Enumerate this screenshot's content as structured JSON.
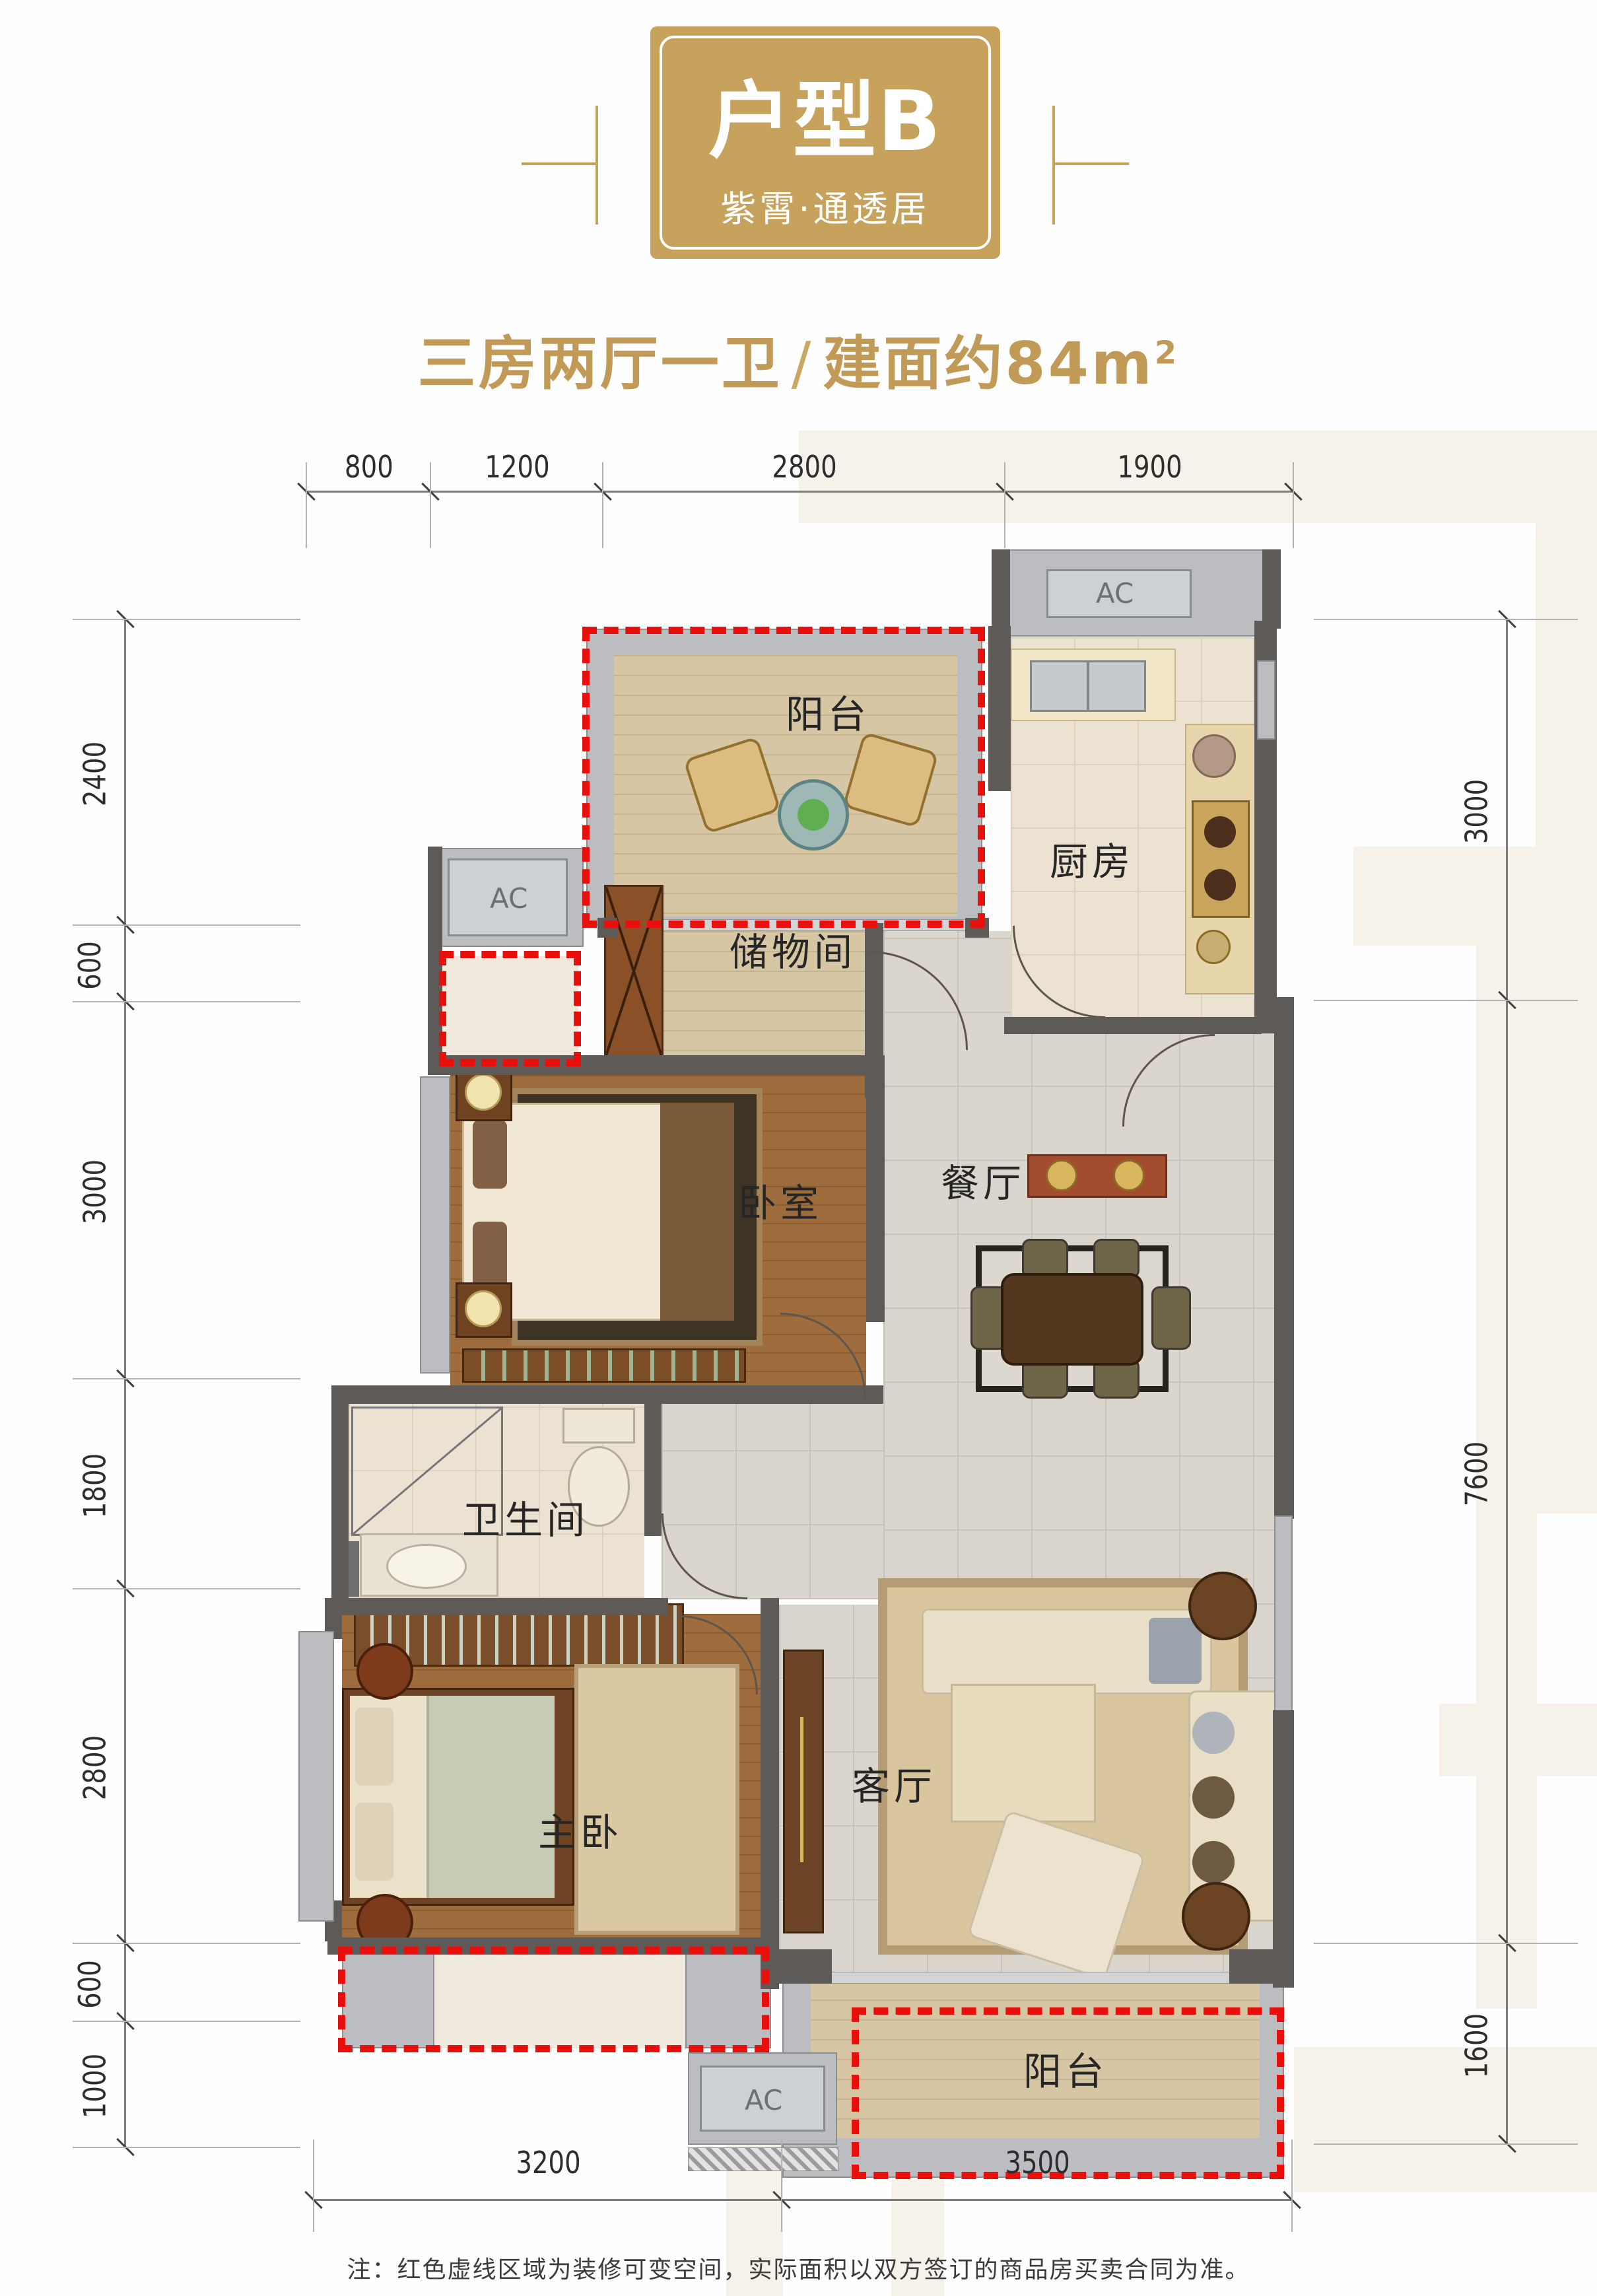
{
  "header": {
    "badge_title": "户型B",
    "badge_tagline": "紫霄·通透居",
    "spec": "三房两厅一卫",
    "divider": "/",
    "area_text": "建面约84m",
    "area_sup": "2"
  },
  "dims": {
    "top": [
      "800",
      "1200",
      "2800",
      "1900"
    ],
    "left": [
      "2400",
      "600",
      "3000",
      "1800",
      "2800",
      "600",
      "1000"
    ],
    "right": [
      "3000",
      "7600",
      "1600"
    ],
    "bottom": [
      "3200",
      "3500"
    ]
  },
  "rooms": {
    "balcony_top": "阳台",
    "kitchen": "厨房",
    "storage": "储物间",
    "bedroom": "卧室",
    "dining": "餐厅",
    "bathroom": "卫生间",
    "master": "主卧",
    "living": "客厅",
    "balcony_bottom": "阳台"
  },
  "ac": {
    "top": "AC",
    "left": "AC",
    "bottom": "AC"
  },
  "note": "注：红色虚线区域为装修可变空间，实际面积以双方签订的商品房买卖合同为准。",
  "colors": {
    "accent_gold": "#C6A25D",
    "dashed_red": "#E8100C",
    "wall_dark": "#5E5A57"
  }
}
